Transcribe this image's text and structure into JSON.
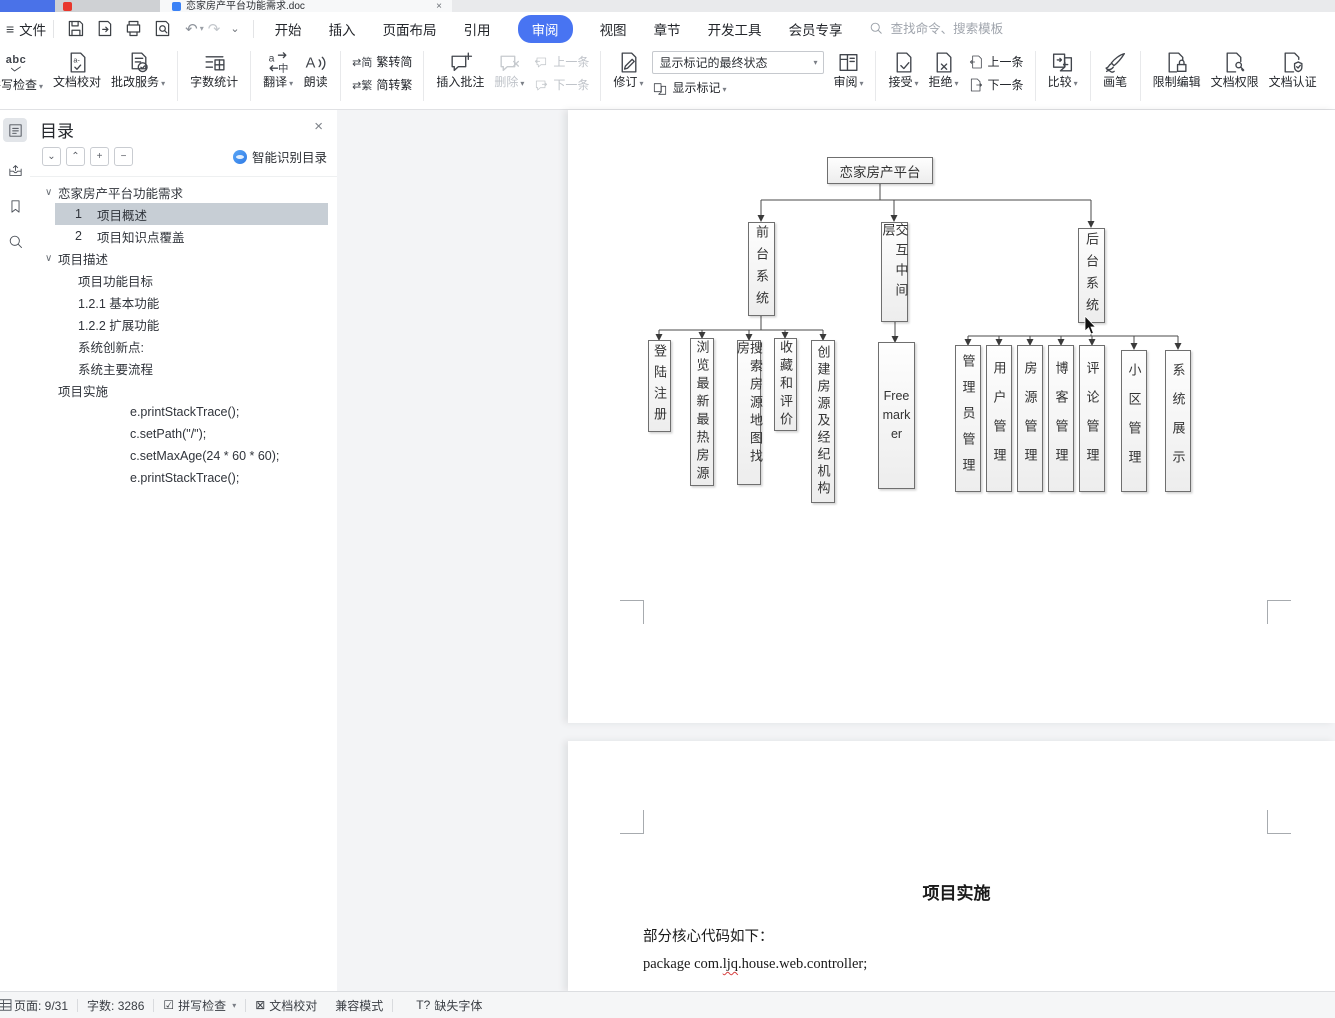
{
  "titlebar": {
    "doc_tab": "恋家房产平台功能需求.doc"
  },
  "menubar": {
    "file": "文件",
    "tabs": [
      "开始",
      "插入",
      "页面布局",
      "引用",
      "审阅",
      "视图",
      "章节",
      "开发工具",
      "会员专享"
    ],
    "search_placeholder": "查找命令、搜索模板"
  },
  "ribbon": {
    "spell_check": "拼写检查",
    "doc_proof": "文档校对",
    "correction": "批改服务",
    "word_count": "字数统计",
    "translate": "翻译",
    "read_aloud": "朗读",
    "trad_simp": "繁转简",
    "simp_trad": "简转繁",
    "insert_comment": "插入批注",
    "delete": "删除",
    "prev_comment": "上一条",
    "next_comment": "下一条",
    "revise": "修订",
    "markup_state": "显示标记的最终状态",
    "show_markup": "显示标记",
    "review_pane": "审阅",
    "accept": "接受",
    "reject": "拒绝",
    "prev_change": "上一条",
    "next_change": "下一条",
    "compare": "比较",
    "brush": "画笔",
    "restrict_edit": "限制编辑",
    "doc_permission": "文档权限",
    "doc_cert": "文档认证"
  },
  "sidebar": {
    "title": "目录",
    "smart_toc": "智能识别目录",
    "tree": [
      {
        "label": "恋家房产平台功能需求"
      },
      {
        "num": "1",
        "label": "项目概述"
      },
      {
        "num": "2",
        "label": "项目知识点覆盖"
      },
      {
        "label": "项目描述"
      },
      {
        "label": "项目功能目标"
      },
      {
        "label": "1.2.1 基本功能"
      },
      {
        "label": "1.2.2 扩展功能"
      },
      {
        "label": "系统创新点:"
      },
      {
        "label": "系统主要流程"
      },
      {
        "label": "项目实施"
      },
      {
        "label": "e.printStackTrace();"
      },
      {
        "label": "c.setPath(\"/\");"
      },
      {
        "label": "c.setMaxAge(24 * 60 * 60);"
      },
      {
        "label": "e.printStackTrace();"
      }
    ]
  },
  "diagram": {
    "root": "恋家房产平台",
    "front": "前台系统",
    "middle": "交互中间层",
    "back": "后台系统",
    "front_leaves": [
      "登陆注册",
      "浏览最新最热房源",
      "搜索房源地图找房",
      "收藏和评价",
      "创建房源及经纪机构"
    ],
    "middle_leaf": "Freemarker",
    "back_leaves": [
      "管理员管理",
      "用户管理",
      "房源管理",
      "博客管理",
      "评论管理",
      "小区管理",
      "系统展示"
    ]
  },
  "page2": {
    "heading": "项目实施",
    "para": "部分核心代码如下：",
    "code_before": "package com.",
    "code_misspelled": "ljq",
    "code_after": ".house.web.controller;"
  },
  "statusbar": {
    "page": "页面: 9/31",
    "words": "字数: 3286",
    "spell": "拼写检查",
    "proof": "文档校对",
    "compat": "兼容模式",
    "missing_font": "缺失字体"
  },
  "icons": {
    "menu": "≡",
    "undo": "↶",
    "redo": "↷",
    "more": "⌄",
    "dropdown": "▾",
    "close": "×",
    "chevron_down": "⌄",
    "chevron_up": "⌃",
    "plus": "+",
    "minus": "−",
    "tree_caret": "∨",
    "checked_box": "☑",
    "crossed_box": "⊠",
    "missing_font_glyph": "T?"
  }
}
